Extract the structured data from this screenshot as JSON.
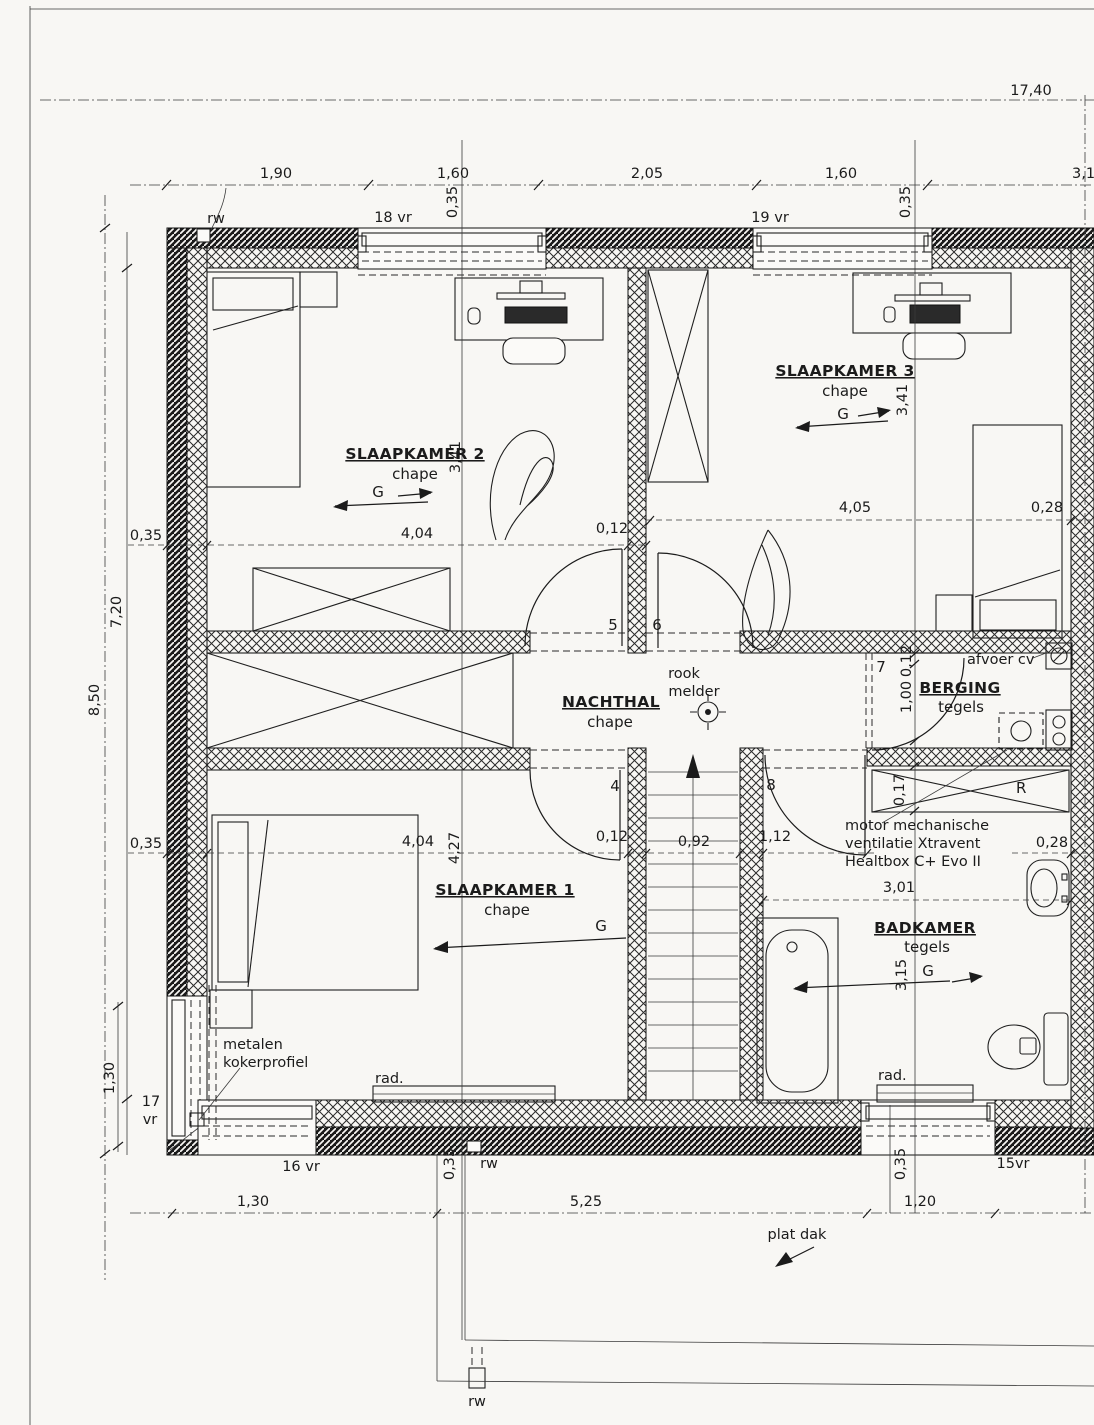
{
  "rooms": {
    "slk1": {
      "name": "SLAAPKAMER 1",
      "floor": "chape"
    },
    "slk2": {
      "name": "SLAAPKAMER 2",
      "floor": "chape"
    },
    "slk3": {
      "name": "SLAAPKAMER 3",
      "floor": "chape"
    },
    "nachthal": {
      "name": "NACHTHAL",
      "floor": "chape"
    },
    "berging": {
      "name": "BERGING",
      "floor": "tegels"
    },
    "badkamer": {
      "name": "BADKAMER",
      "floor": "tegels"
    }
  },
  "doors": {
    "d4": "4",
    "d5": "5",
    "d6": "6",
    "d7": "7",
    "d8": "8"
  },
  "windows": {
    "w15": "15vr",
    "w16": "16 vr",
    "w17a": "17",
    "w17b": "vr",
    "w18": "18 vr",
    "w19": "19 vr"
  },
  "dims": {
    "total": "17,40",
    "t190": "1,90",
    "t160": "1,60",
    "t205": "2,05",
    "t31": "3,1",
    "left_total": "8,50",
    "left_inner": "7,20",
    "wall035": "0,35",
    "d130": "1,30",
    "d404": "4,04",
    "d012": "0,12",
    "d405": "4,05",
    "d028": "0,28",
    "d341": "3,41",
    "d427": "4,27",
    "d092": "0,92",
    "d112": "1,12",
    "d301": "3,01",
    "d315": "3,15",
    "d100": "1,00",
    "d017": "0,17",
    "d525": "5,25",
    "d120": "1,20"
  },
  "annotations": {
    "rw": "rw",
    "rad": "rad.",
    "g": "G",
    "r": "R",
    "rook_line1": "rook",
    "rook_line2": "melder",
    "afvoer_cv": "afvoer cv",
    "plat_dak": "plat dak",
    "metalen_line1": "metalen",
    "metalen_line2": "kokerprofiel",
    "motor_line1": "motor mechanische",
    "motor_line2": "ventilatie Xtravent",
    "motor_line3": "Healtbox C+ Evo II"
  },
  "colors": {
    "ink": "#1b1b1b",
    "paper": "#f8f7f4"
  }
}
